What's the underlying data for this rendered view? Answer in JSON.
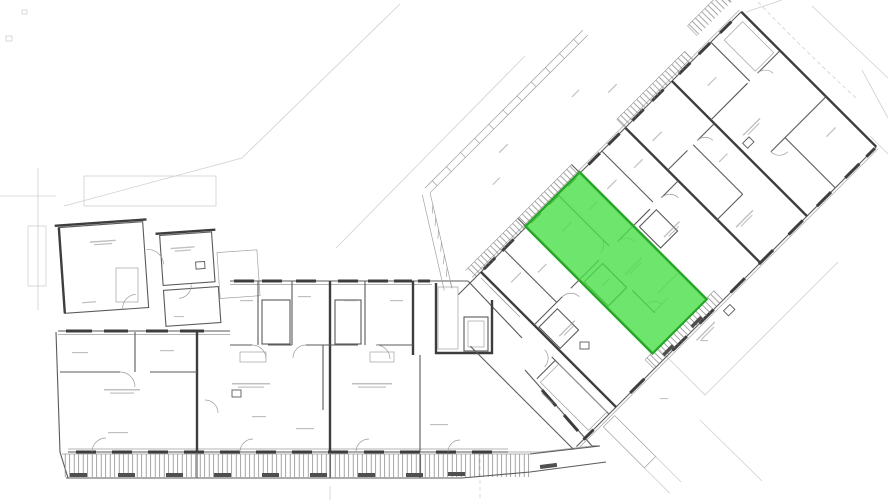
{
  "meta": {
    "title": "Building floor plan",
    "description": "Architectural floor plan of an apartment building with a long lower wing and a 45-degree angled upper wing; one apartment unit in the angled wing is highlighted in green. Balconies with railing hatching line the facades; stair cores and an elevator are drawn; all annotation text is micro-sized and illegible."
  },
  "highlight": {
    "name": "selected-unit",
    "fill": "#4ade48",
    "border": "#23a523",
    "opacity": "0.8"
  },
  "palette": {
    "bg": "#ffffff",
    "wall": "#3d3d3d",
    "wallM": "#5a5a5a",
    "hair": "#9b9b9b",
    "faint": "#d0d0d0",
    "smudge": "#8c8c8c",
    "block": "#4f4f4f"
  }
}
